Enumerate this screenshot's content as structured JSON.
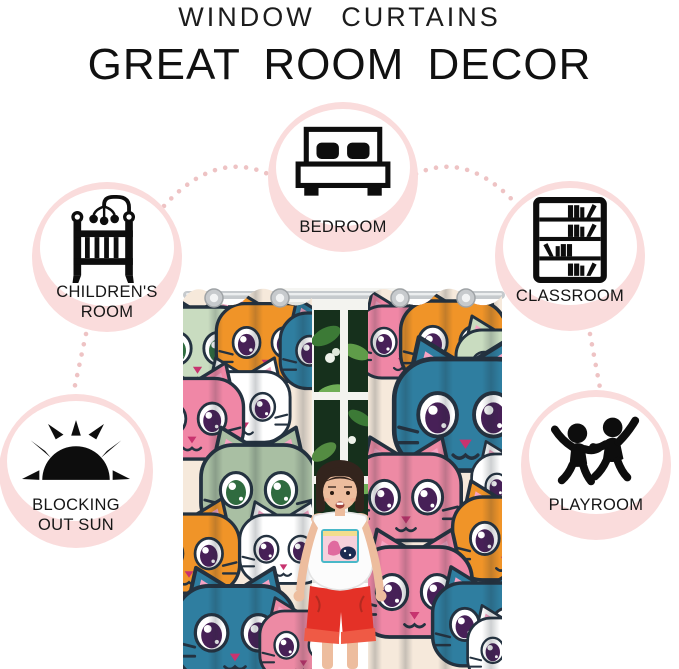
{
  "header": {
    "subtitle": "WINDOW CURTAINS",
    "title": "GREAT ROOM DECOR"
  },
  "badges": [
    {
      "id": "bedroom",
      "icon": "bed-icon",
      "label1": "BEDROOM",
      "label2": ""
    },
    {
      "id": "childrens-room",
      "icon": "crib-icon",
      "label1": "CHILDREN'S",
      "label2": "ROOM"
    },
    {
      "id": "classroom",
      "icon": "bookshelf-icon",
      "label1": "CLASSROOM",
      "label2": ""
    },
    {
      "id": "blocking-out-sun",
      "icon": "sun-icon",
      "label1": "BLOCKING",
      "label2": "OUT SUN"
    },
    {
      "id": "playroom",
      "icon": "children-playing-icon",
      "label1": "PLAYROOM",
      "label2": ""
    }
  ],
  "colors": {
    "badge_fill": "#fadcdc",
    "badge_ring": "#f6d2d3",
    "connector_dot": "#eec3c4",
    "icon_black": "#0d0d0d",
    "curtain_orange": "#f09428",
    "curtain_pink": "#f087a6",
    "curtain_rose": "#ed8aa4",
    "curtain_teal": "#2f7ea0",
    "curtain_sage": "#c9dcc0",
    "curtain_gray": "#a9bfa3",
    "cat_white": "#ffffff",
    "inner_ear_pink": "#f6a3c3",
    "eye_purple": "#472057",
    "eye_green": "#2f6b3f",
    "nose_pink": "#c8336f",
    "shorts_red": "#e43127",
    "skin": "#edbd9e",
    "hair_brown": "#33241d",
    "foliage_dark": "#16301c",
    "foliage_green": "#3c7a36",
    "rod_silver": "#c6cacd"
  }
}
